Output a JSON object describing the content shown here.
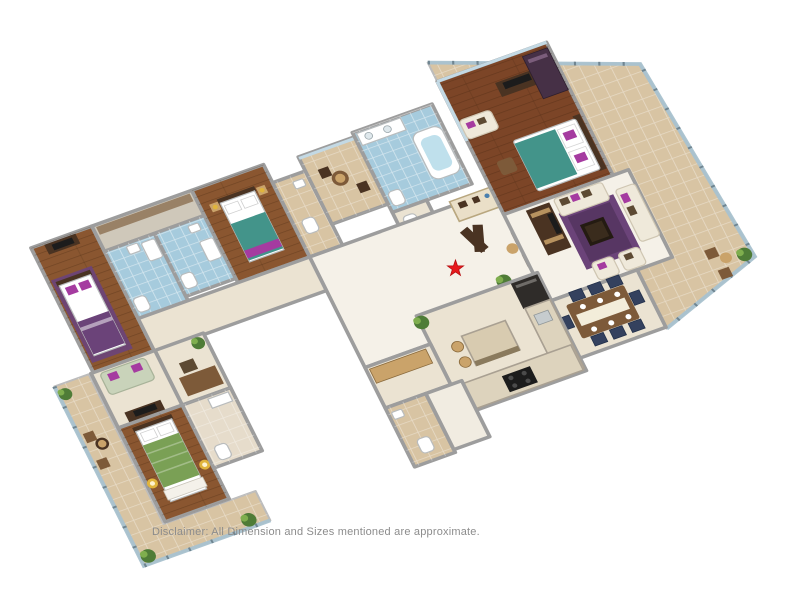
{
  "page": {
    "background": "#ffffff"
  },
  "disclaimer": {
    "text": "Disclaimer: All Dimension and Sizes mentioned are approximate."
  },
  "marker": {
    "name": "red-star-marker",
    "color": "#e8191c"
  },
  "rooms": [
    "master-bedroom",
    "master-bathroom",
    "living-room",
    "dining-area",
    "kitchen",
    "bedroom-2",
    "bedroom-3",
    "bedroom-4",
    "bathroom-2",
    "bathroom-3",
    "bathroom-4",
    "powder-toilet",
    "utility-room",
    "entrance-foyer",
    "corridor",
    "lounge",
    "study",
    "bistro-balcony",
    "wrap-around-balcony",
    "terrace-balcony"
  ],
  "colors": {
    "wood_floor": "#8a5630",
    "wood_floor_red": "#7c4527",
    "wall_gray": "#9d9d9d",
    "wall_light": "#bcbcbc",
    "marble": "#f5f1e8",
    "cream_floor": "#ebe3d2",
    "tile_beige": "#d8c4a3",
    "tile_blue": "#a6cbdd",
    "glass": "#a9c2cf",
    "rug_purple": "#6b4379",
    "bed_teal": "#43948a",
    "bed_green": "#7aa055",
    "sofa_cream": "#efe9da",
    "sofa_sage": "#c9d3ba",
    "pillow_magenta": "#a53ba0",
    "navy": "#34415e",
    "dark_wood": "#4a3322",
    "mid_wood": "#7d5a39",
    "light_wood": "#caa36a",
    "plant_green": "#4f7c37",
    "plant_light": "#7fae4e",
    "star_red": "#e8191c",
    "text_gray": "#8c8c8c"
  }
}
